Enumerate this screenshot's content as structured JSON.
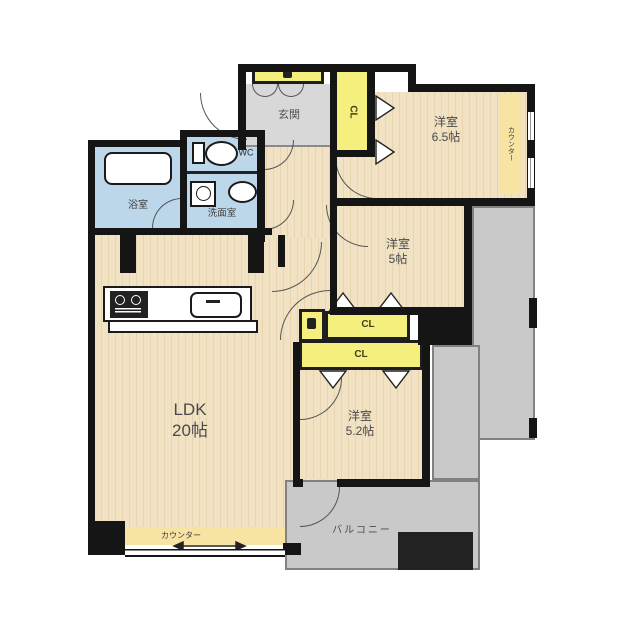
{
  "rooms": {
    "ldk": {
      "name": "LDK",
      "size": "20帖"
    },
    "bedroom_65": {
      "name": "洋室",
      "size": "6.5帖"
    },
    "bedroom_5": {
      "name": "洋室",
      "size": "5帖"
    },
    "bedroom_52": {
      "name": "洋室",
      "size": "5.2帖"
    },
    "entrance": {
      "name": "玄関"
    },
    "bath": {
      "name": "浴室"
    },
    "washroom": {
      "name": "洗面室"
    },
    "toilet": {
      "name": "WC"
    },
    "balcony": {
      "name": "バルコニー"
    }
  },
  "closets": {
    "entrance_cl": "CL",
    "bedroom5_cl": "CL",
    "bedroom52_cl": "CL"
  },
  "counters": {
    "ldk_counter": "カウンター",
    "bedroom65_counter": "カウンター"
  },
  "colors": {
    "wall": "#151515",
    "wood_floor": "#f2e2c4",
    "water_rooms": "#bcd7ea",
    "closet": "#f5ef7d",
    "counter": "#f7e3a2",
    "entrance_floor": "#d8d8d8",
    "balcony": "#c9c9c9"
  }
}
